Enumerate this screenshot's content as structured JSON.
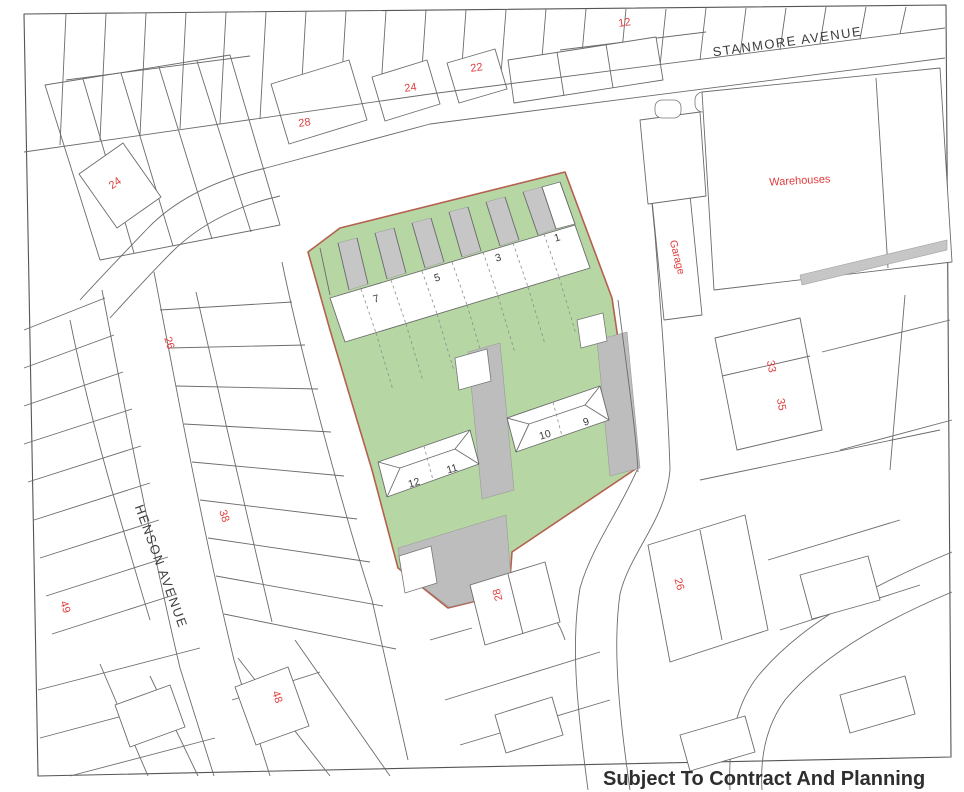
{
  "map": {
    "streets": {
      "stanmore": "STANMORE AVENUE",
      "henson": "HENSON AVENUE"
    },
    "buildings": {
      "warehouses": "Warehouses",
      "garage": "Garage"
    },
    "red_numbers": {
      "stanmore_north_12": "12",
      "stanmore_north_22": "22",
      "stanmore_north_24": "24",
      "stanmore_north_28": "28",
      "top_left_24": "24",
      "henson_east_26": "26",
      "henson_east_38": "38",
      "henson_west_49": "49",
      "henson_east_48": "48",
      "east_33": "33",
      "east_35": "35",
      "southeast_26": "26",
      "south_28": "28"
    },
    "site_plots": {
      "plot_1": "1",
      "plot_3": "3",
      "plot_5": "5",
      "plot_7": "7",
      "plot_9": "9",
      "plot_10": "10",
      "plot_11": "11",
      "plot_12": "12"
    },
    "colors": {
      "site_green": "#b6d7a4",
      "driveway_gray": "#bdbdbd",
      "boundary_red": "#b4604f",
      "label_red": "#e03c3c",
      "parcel_line": "#6b6b6b"
    }
  },
  "footer": {
    "text": "Subject To Contract And Planning"
  }
}
